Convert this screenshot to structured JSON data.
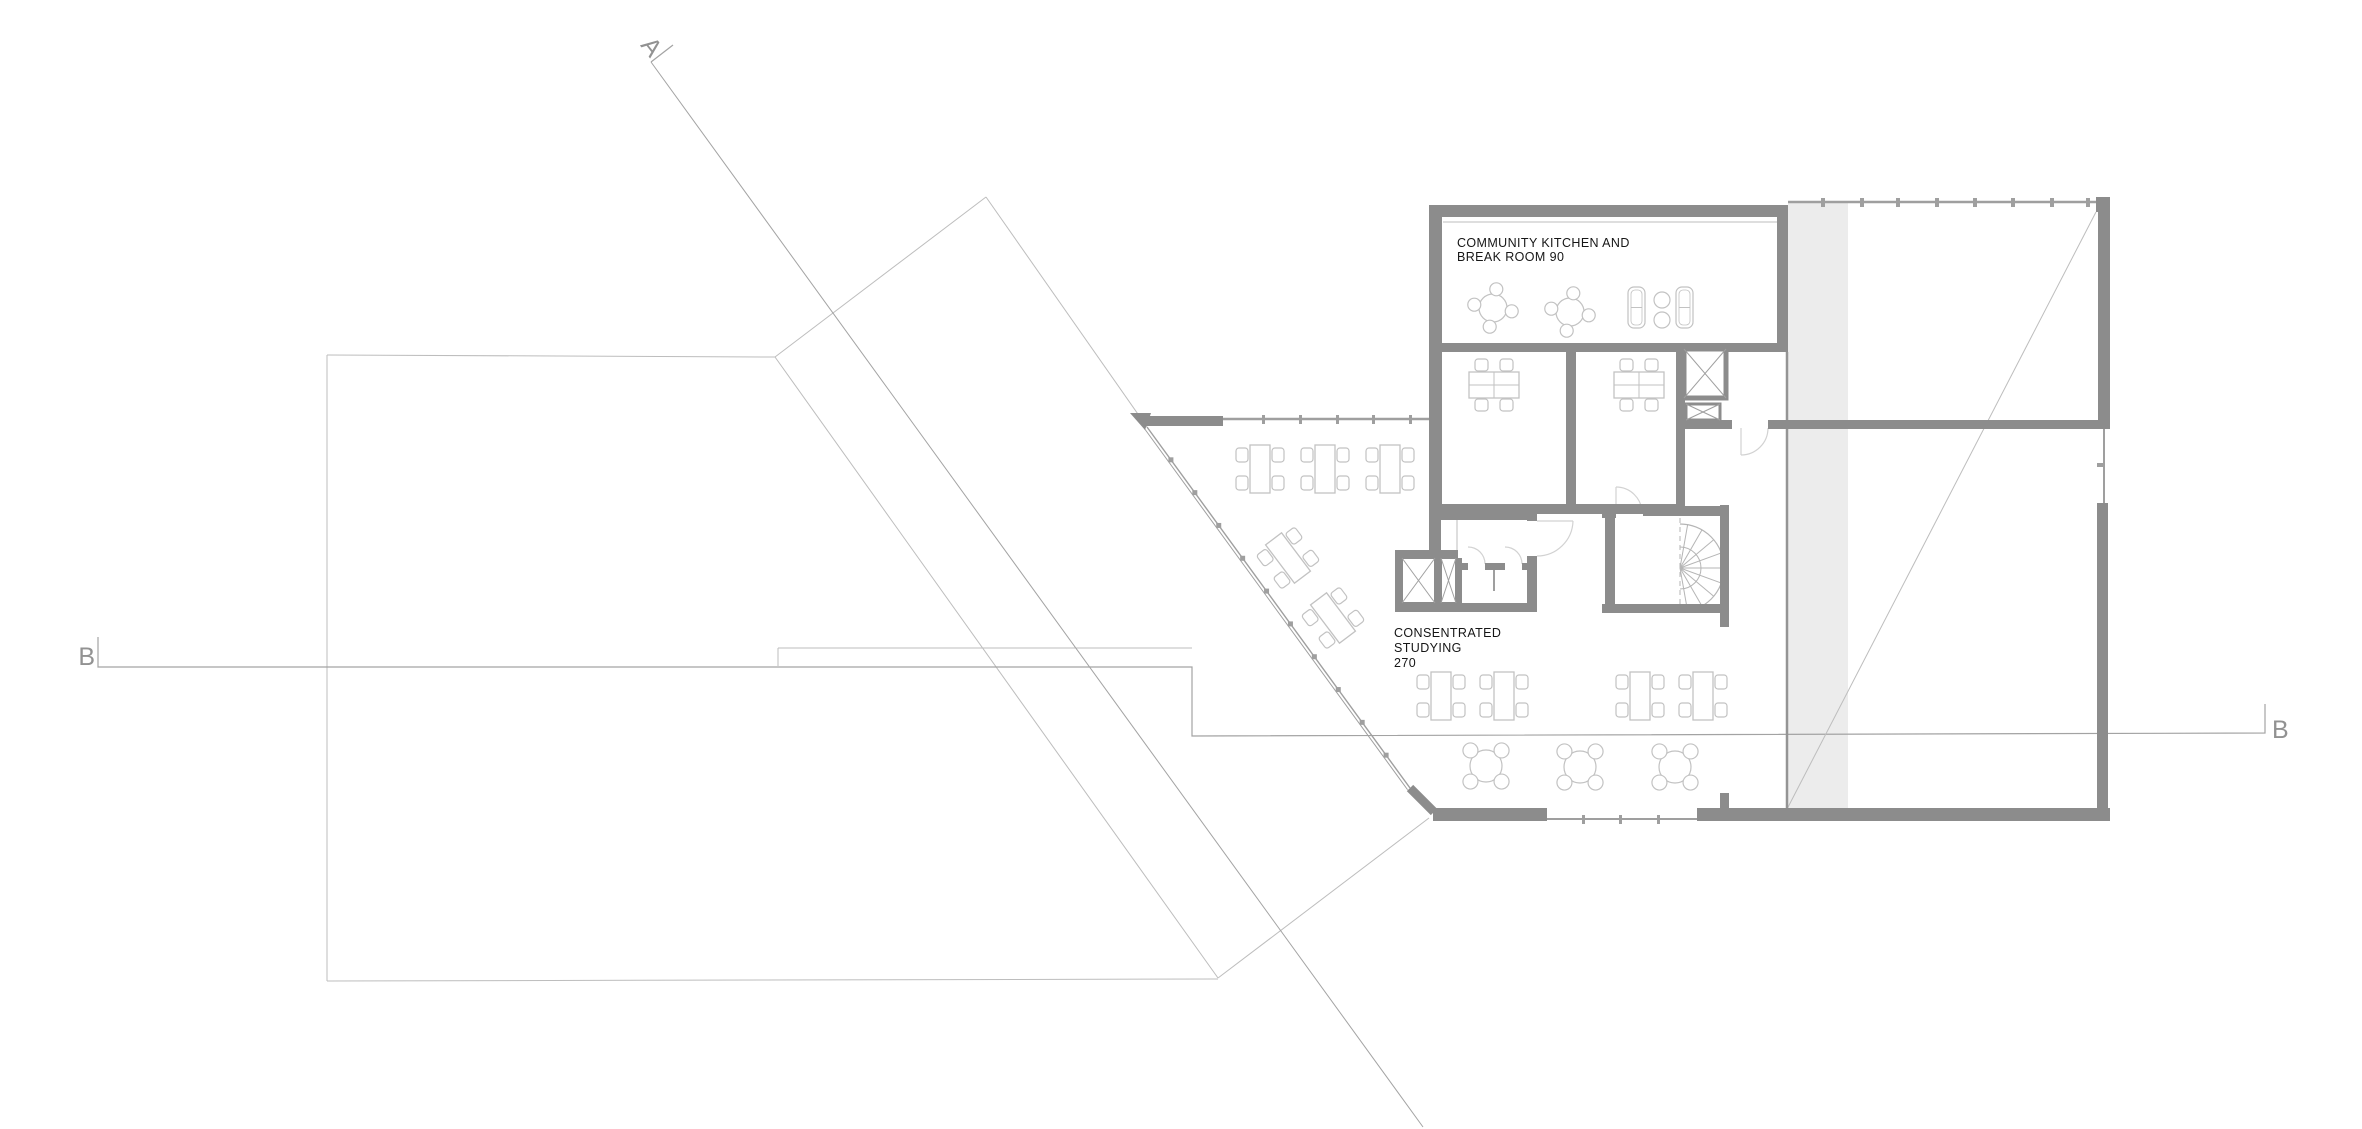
{
  "drawing": {
    "type": "architectural-floor-plan",
    "canvas": {
      "w": 2362,
      "h": 1129
    }
  },
  "labels": {
    "kitchen": {
      "line1": "COMMUNITY KITCHEN AND",
      "line2": "BREAK ROOM 90"
    },
    "studying": {
      "line1": "CONSENTRATED",
      "line2": "STUDYING",
      "line3": "270"
    },
    "sections": {
      "a": "A",
      "b_left": "B",
      "b_right": "B"
    }
  },
  "colors": {
    "wall": "#8c8c8c",
    "wall_light": "#9f9f9f",
    "glazing": "#9f9f9f",
    "thin": "#bdbdbd",
    "section_line": "#a3a3a3",
    "furniture": "#c2c2c2",
    "door": "#d2d2d2",
    "band_fill": "#ececec",
    "band_edge": "#949494",
    "stair": "#b5b5b5",
    "label_text": "#161616",
    "section_text": "#929292"
  },
  "plan": {
    "gray_band": {
      "x": 1788,
      "y": 203,
      "w": 60,
      "h": 610
    },
    "walls": [
      [
        1429,
        205,
        359,
        12
      ],
      [
        1429,
        205,
        13,
        314
      ],
      [
        1777,
        205,
        11,
        146
      ],
      [
        1429,
        343,
        359,
        9
      ],
      [
        1566,
        352,
        10,
        160
      ],
      [
        1676,
        352,
        9,
        160
      ],
      [
        1429,
        504,
        256,
        10
      ],
      [
        1680,
        420,
        52,
        9
      ],
      [
        1768,
        420,
        342,
        9
      ],
      [
        2098,
        210,
        12,
        219
      ],
      [
        2096,
        197,
        14,
        15
      ],
      [
        2097,
        503,
        11,
        318
      ],
      [
        1697,
        808,
        413,
        13
      ],
      [
        1433,
        808,
        114,
        13
      ],
      [
        1720,
        793,
        9,
        17
      ],
      [
        1145,
        416,
        78,
        10
      ],
      [
        1429,
        511,
        108,
        9
      ],
      [
        1429,
        511,
        12,
        47
      ],
      [
        1395,
        550,
        63,
        8
      ],
      [
        1395,
        550,
        7,
        62
      ],
      [
        1435,
        558,
        6,
        45
      ],
      [
        1456,
        558,
        6,
        45
      ],
      [
        1395,
        603,
        140,
        9
      ],
      [
        1527,
        511,
        10,
        10
      ],
      [
        1527,
        556,
        10,
        56
      ],
      [
        1457,
        563,
        11,
        7
      ],
      [
        1485,
        563,
        20,
        7
      ],
      [
        1522,
        563,
        10,
        7
      ],
      [
        1602,
        504,
        14,
        14
      ],
      [
        1605,
        504,
        10,
        106
      ],
      [
        1643,
        506,
        86,
        10
      ],
      [
        1720,
        505,
        9,
        122
      ],
      [
        1602,
        604,
        118,
        9
      ]
    ],
    "thick_diag": {
      "x1": 1410,
      "y1": 788,
      "x2": 1434,
      "y2": 812,
      "w": 9
    },
    "entrance_triangle": [
      [
        1130,
        413
      ],
      [
        1151,
        413
      ],
      [
        1145,
        430
      ]
    ],
    "elevator": {
      "x": 1684,
      "y": 349,
      "w": 42,
      "h": 49,
      "stroke": 5
    },
    "small_shaft": {
      "x": 1686,
      "y": 404,
      "w": 34,
      "h": 16,
      "stroke": 3
    },
    "x_boxes": [
      {
        "x": 1402,
        "y": 558,
        "w": 33,
        "h": 45
      },
      {
        "x": 1441,
        "y": 558,
        "w": 15,
        "h": 45
      }
    ],
    "glazing_lines": [
      {
        "x1": 1223,
        "y1": 419,
        "x2": 1435,
        "y2": 419,
        "w": 2.5
      },
      {
        "x1": 1788,
        "y1": 202,
        "x2": 2098,
        "y2": 202,
        "w": 2.5
      },
      {
        "x1": 2104,
        "y1": 429,
        "x2": 2104,
        "y2": 503,
        "w": 2
      },
      {
        "x1": 1547,
        "y1": 819,
        "x2": 1697,
        "y2": 819,
        "w": 2
      }
    ],
    "diag_glazing": {
      "x1": 1147,
      "y1": 427,
      "x2": 1410,
      "y2": 788,
      "offset": 3,
      "ticks": 10
    },
    "tick_rects": [
      [
        1262,
        415,
        3,
        9
      ],
      [
        1299,
        415,
        3,
        9
      ],
      [
        1336,
        415,
        3,
        9
      ],
      [
        1372,
        415,
        3,
        9
      ],
      [
        1409,
        415,
        3,
        9
      ],
      [
        1821,
        198,
        4,
        9
      ],
      [
        1860,
        198,
        4,
        9
      ],
      [
        1896,
        198,
        4,
        9
      ],
      [
        1935,
        198,
        4,
        9
      ],
      [
        1973,
        198,
        4,
        9
      ],
      [
        2011,
        198,
        4,
        9
      ],
      [
        2050,
        198,
        4,
        9
      ],
      [
        2086,
        198,
        4,
        9
      ],
      [
        1582,
        815,
        3,
        9
      ],
      [
        1619,
        815,
        3,
        9
      ],
      [
        1657,
        815,
        3,
        9
      ],
      [
        2097,
        463,
        8,
        4
      ]
    ],
    "thin_lines": [
      {
        "x1": 1443,
        "y1": 222,
        "x2": 1777,
        "y2": 222,
        "w": 1,
        "c": "thin"
      },
      {
        "x1": 1787,
        "y1": 352,
        "x2": 1787,
        "y2": 808,
        "w": 2.5,
        "c": "band_edge"
      },
      {
        "x1": 1457,
        "y1": 520,
        "x2": 1457,
        "y2": 563,
        "w": 1,
        "c": "thin"
      },
      {
        "x1": 1494,
        "y1": 570,
        "x2": 1494,
        "y2": 591,
        "w": 2,
        "c": "glazing"
      },
      {
        "x1": 1486,
        "y1": 569,
        "x2": 1503,
        "y2": 569,
        "w": 2,
        "c": "glazing"
      },
      {
        "x1": 1458,
        "y1": 569,
        "x2": 1465,
        "y2": 569,
        "w": 2,
        "c": "glazing"
      },
      {
        "x1": 1524,
        "y1": 569,
        "x2": 1531,
        "y2": 569,
        "w": 2,
        "c": "glazing"
      }
    ],
    "below_outline": [
      [
        327,
        355,
        775,
        357
      ],
      [
        327,
        355,
        327,
        981
      ],
      [
        327,
        981,
        1218,
        979
      ],
      [
        775,
        357,
        986,
        197
      ],
      [
        986,
        197,
        1147,
        427
      ],
      [
        775,
        357,
        1218,
        978
      ],
      [
        1429,
        818,
        1218,
        978
      ],
      [
        778,
        666,
        778,
        648
      ],
      [
        778,
        648,
        1192,
        648
      ]
    ],
    "right_room_diag": [
      2096,
      212,
      1785,
      813
    ],
    "section_a": {
      "tick": [
        651,
        62,
        673,
        45
      ],
      "line": [
        651,
        62,
        1423,
        1127
      ]
    },
    "section_b": {
      "points": [
        [
          98,
          637
        ],
        [
          98,
          667
        ],
        [
          1192,
          667
        ],
        [
          1192,
          736
        ],
        [
          2265,
          733
        ],
        [
          2265,
          704
        ]
      ]
    },
    "doors": [
      "M1741,455 A27,27 0 0 0 1768,428",
      "M1741,428 L1741,455",
      "M1537,521 L1573,521",
      "M1573,521 A36,36 0 0 1 1537,556",
      "M1616,487 L1616,513",
      "M1616,487 A26,26 0 0 1 1642,513",
      "M1485,564 A17,17 0 0 0 1468,547",
      "M1522,564 A17,17 0 0 0 1505,547"
    ],
    "furniture": {
      "tables_straight": {
        "row1_y": 469,
        "row1_x": [
          1260,
          1325,
          1390
        ],
        "row2_y": 696,
        "row2_x": [
          1441,
          1504,
          1640,
          1703
        ]
      },
      "tables_rotated": [
        {
          "cx": 1288,
          "cy": 558,
          "angle": -37
        },
        {
          "cx": 1333,
          "cy": 618,
          "angle": -37
        }
      ],
      "office_tables": [
        [
          1494,
          385
        ],
        [
          1639,
          385
        ]
      ],
      "round_tables_hall": [
        [
          1486,
          766
        ],
        [
          1580,
          767
        ],
        [
          1675,
          767
        ]
      ],
      "round_tables_kitchen": [
        [
          1493,
          308
        ],
        [
          1570,
          312
        ]
      ],
      "lounge": {
        "sofas": [
          [
            1628,
            287,
            17,
            41
          ],
          [
            1676,
            287,
            17,
            41
          ]
        ],
        "poufs": [
          [
            1662,
            300,
            8
          ],
          [
            1662,
            320,
            8
          ]
        ]
      },
      "stair": {
        "cx": 1680,
        "cy": 568,
        "r": 44,
        "r_inner": 21,
        "spokes": 9
      }
    }
  }
}
